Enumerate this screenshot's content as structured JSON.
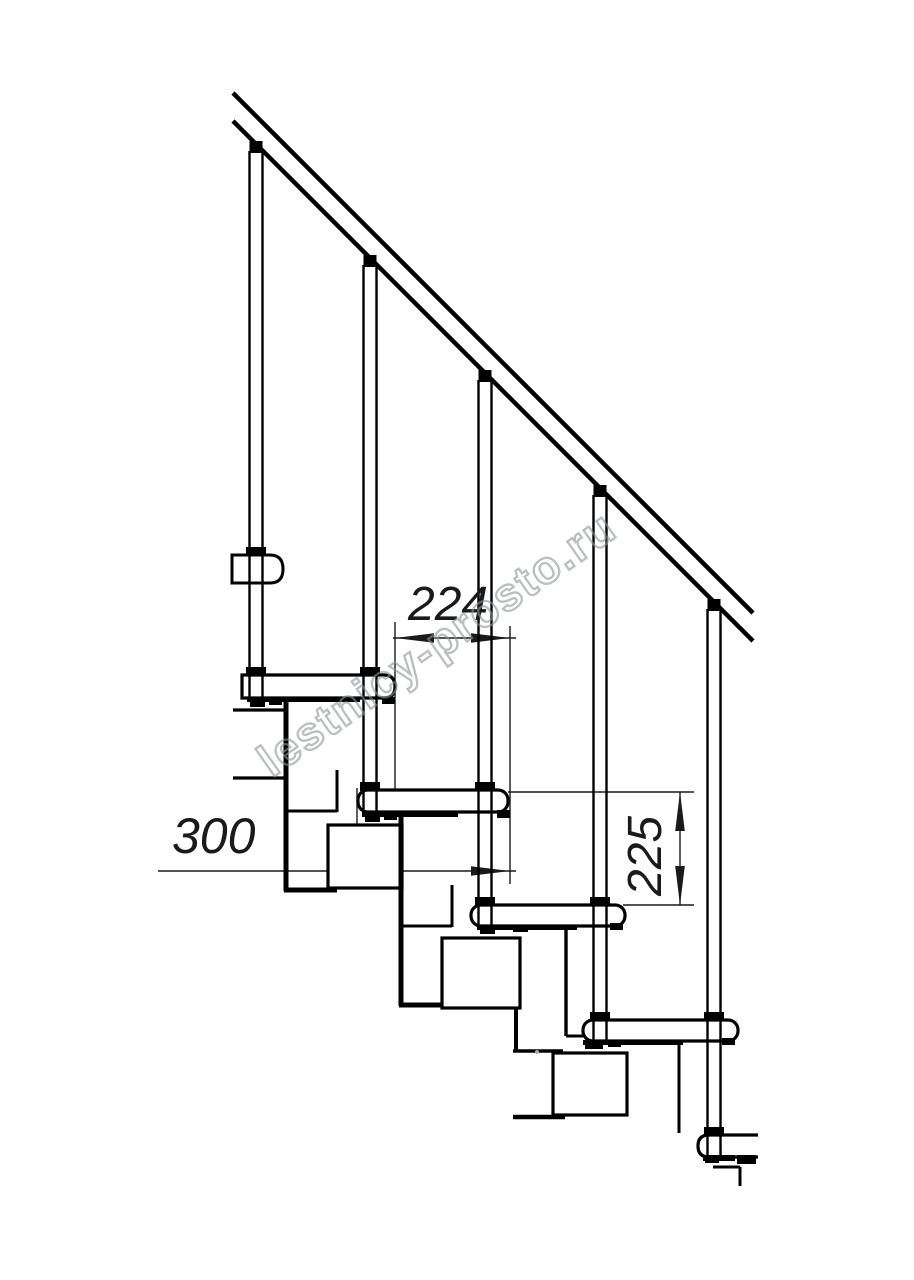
{
  "drawing": {
    "dimensions": {
      "step_run": "224",
      "tread_depth": "300",
      "step_rise": "225"
    },
    "watermark_text": "lestnicy-prosto.ru",
    "colors": {
      "line": "#000000",
      "dimension": "#1a1a1a",
      "watermark": "#8f959b",
      "background": "#ffffff"
    }
  }
}
